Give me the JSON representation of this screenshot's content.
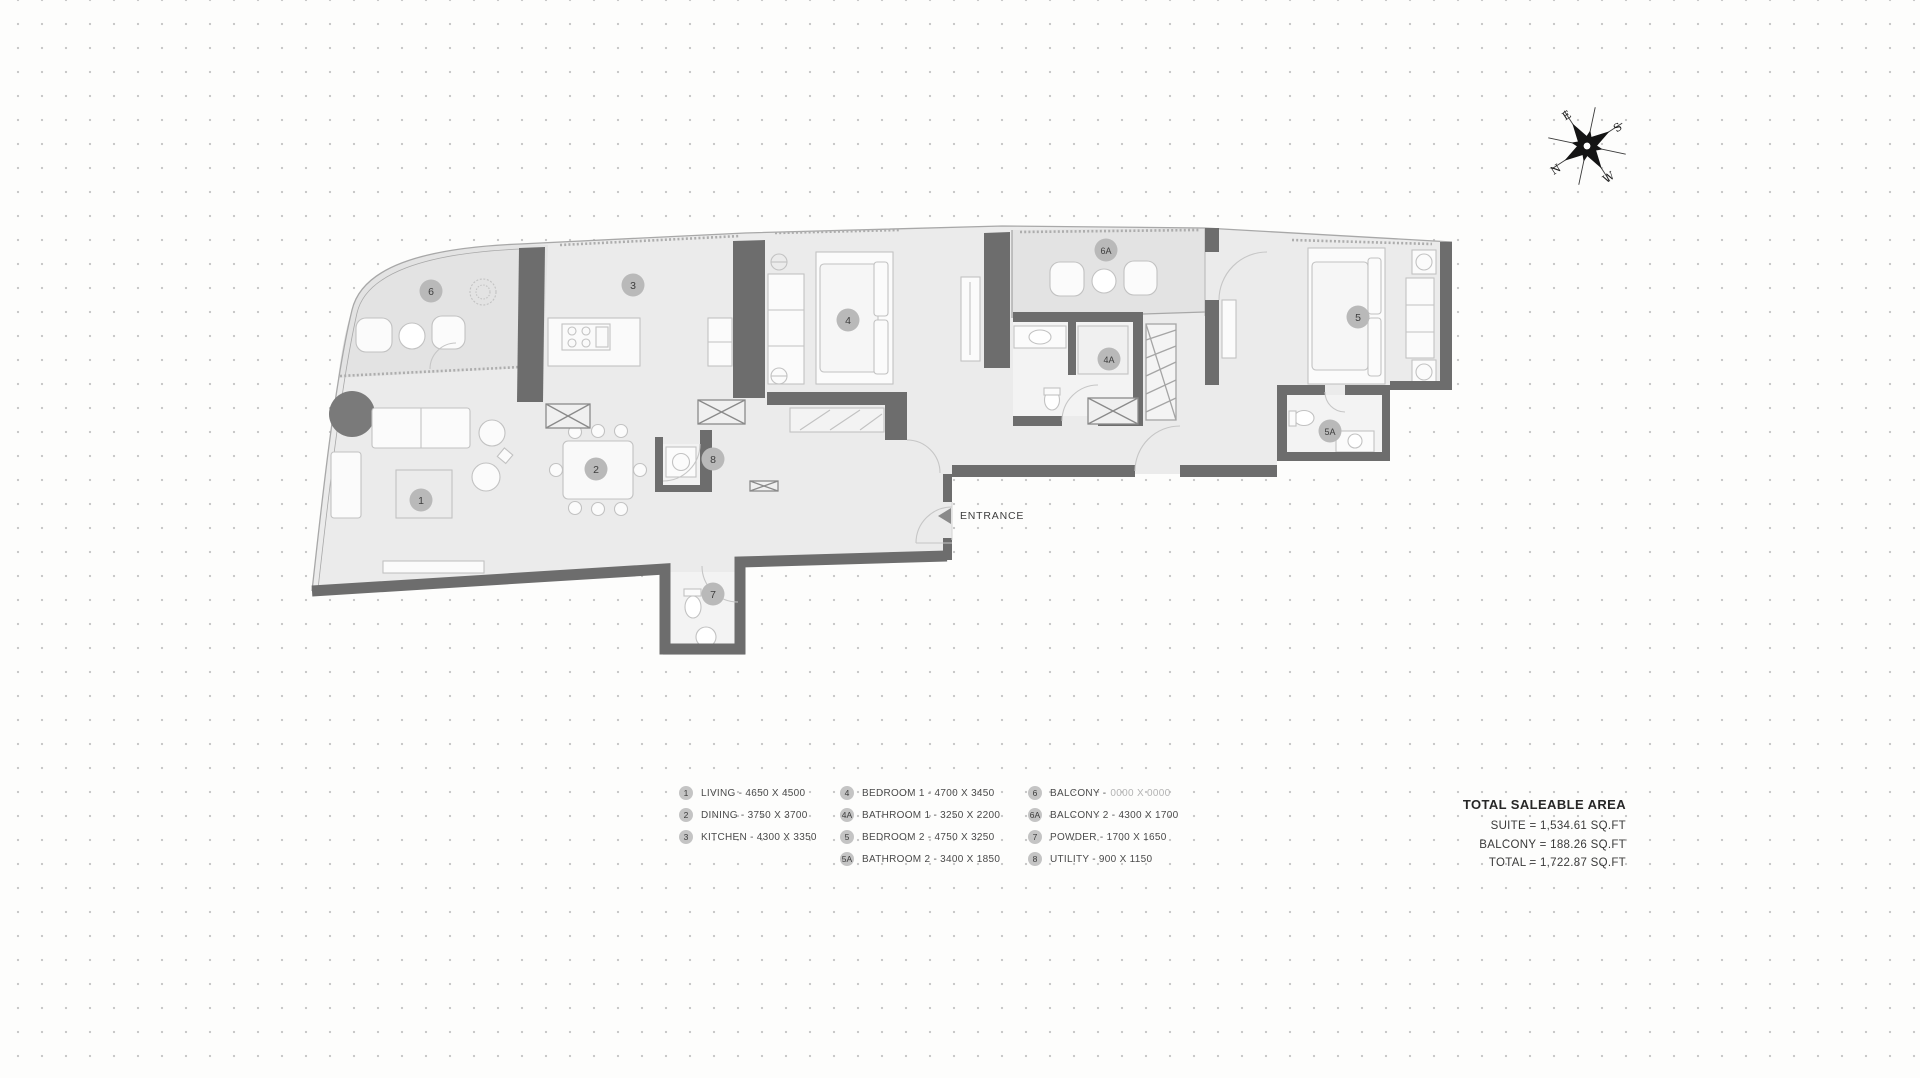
{
  "compass": {
    "n": "N",
    "e": "E",
    "s": "S",
    "w": "W"
  },
  "plan": {
    "entrance_label": "ENTRANCE",
    "badges": {
      "living": "1",
      "dining": "2",
      "kitchen": "3",
      "bedroom1": "4",
      "bathroom1": "4A",
      "bedroom2": "5",
      "bathroom2": "5A",
      "balcony": "6",
      "balcony2": "6A",
      "powder": "7",
      "utility": "8"
    }
  },
  "legend": {
    "col1": [
      {
        "num": "1",
        "text": "LIVING - 4650 X 4500",
        "muted": ""
      },
      {
        "num": "2",
        "text": "DINING - 3750 X 3700",
        "muted": ""
      },
      {
        "num": "3",
        "text": "KITCHEN - 4300 X 3350",
        "muted": ""
      }
    ],
    "col2": [
      {
        "num": "4",
        "text": "BEDROOM 1 - 4700 X 3450",
        "muted": ""
      },
      {
        "num": "4A",
        "text": "BATHROOM 1 - 3250 X 2200",
        "muted": ""
      },
      {
        "num": "5",
        "text": "BEDROOM 2 - 4750 X 3250",
        "muted": ""
      },
      {
        "num": "5A",
        "text": "BATHROOM 2 - 3400 X 1850",
        "muted": ""
      }
    ],
    "col3": [
      {
        "num": "6",
        "text": "BALCONY -",
        "muted": "0000 X 0000"
      },
      {
        "num": "6A",
        "text": "BALCONY 2 - 4300 X 1700",
        "muted": ""
      },
      {
        "num": "7",
        "text": "POWDER - 1700 X 1650",
        "muted": ""
      },
      {
        "num": "8",
        "text": "UTILITY - 900 X 1150",
        "muted": ""
      }
    ]
  },
  "totals": {
    "title": "TOTAL SALEABLE AREA",
    "lines": [
      "SUITE = 1,534.61 SQ.FT",
      "BALCONY = 188.26 SQ.FT",
      "TOTAL = 1,722.87 SQ.FT"
    ]
  }
}
